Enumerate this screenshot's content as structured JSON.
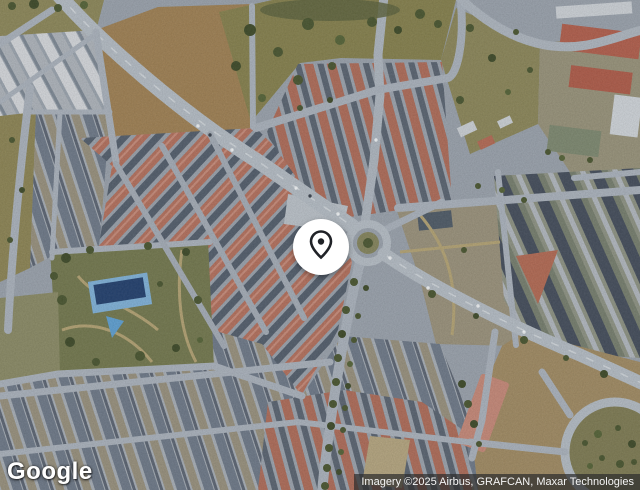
{
  "map": {
    "view_type": "satellite",
    "marker": {
      "icon": "location-pin-icon",
      "pin_fill": "#ffffff",
      "glyph_color": "#202227"
    }
  },
  "branding": {
    "logo_text": "Google"
  },
  "attribution": {
    "text": "Imagery ©2025 Airbus, GRAFCAN, Maxar Technologies"
  },
  "colors": {
    "attribution-bg": "rgba(46,46,46,0.72)",
    "attribution-text": "#f5f5f5",
    "logo-text": "#ffffff",
    "marker-circle": "#ffffff",
    "marker-glyph": "#202227"
  }
}
